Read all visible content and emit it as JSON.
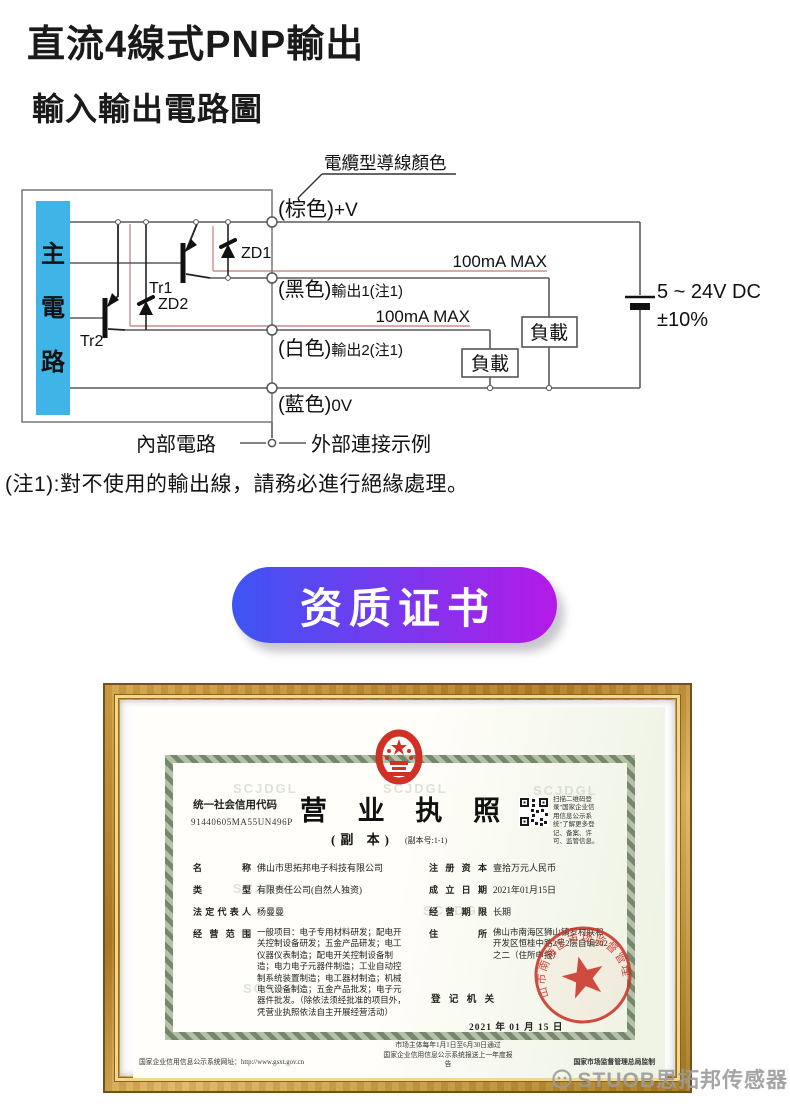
{
  "page": {
    "title": "直流4線式PNP輸出",
    "subtitle": "輸入輸出電路圖",
    "watermark": "STUOB思拓邦传感器"
  },
  "circuit": {
    "pointer_label": "電纜型導線顏色",
    "main_chars": [
      "主",
      "電",
      "路"
    ],
    "wires": [
      {
        "color": "(棕色)",
        "signal": "+V"
      },
      {
        "color": "(黑色)",
        "signal": "輸出1(注1)",
        "current": "100mA MAX"
      },
      {
        "color": "(白色)",
        "signal": "輸出2(注1)",
        "current": "100mA MAX"
      },
      {
        "color": "(藍色)",
        "signal": "0V"
      }
    ],
    "transistor1": "Tr1",
    "transistor2": "Tr2",
    "zener1": "ZD1",
    "zener2": "ZD2",
    "load_label": "負載",
    "supply_line1": "5 ~ 24V DC",
    "supply_line2": "±10%",
    "internal_label": "內部電路",
    "external_label": "外部連接示例",
    "note": "(注1):對不使用的輸出線，請務必進行絕緣處理。"
  },
  "cta": {
    "label": "资质证书",
    "gradient_from": "#3d55f3",
    "gradient_to": "#b41ae8"
  },
  "license": {
    "bg_watermark": "SCJDGL",
    "code_label": "统一社会信用代码",
    "code_value": "91440605MA55UN496P",
    "title": "营 业 执 照",
    "subtitle": "(副 本)",
    "copy_no": "(副本号:1-1)",
    "qr_caption": "扫描二维码登录\"国家企业信用信息公示系统\"了解更多登记、备案、许可、监管信息。",
    "fields_left": [
      {
        "label": "名称",
        "value": "佛山市思拓邦电子科技有限公司"
      },
      {
        "label": "类型",
        "value": "有限责任公司(自然人独资)"
      },
      {
        "label": "法定代表人",
        "value": "杨曼曼"
      },
      {
        "label": "经营范围",
        "value": "一般项目：电子专用材料研发；配电开关控制设备研发；五金产品研发；电工仪器仪表制造；配电开关控制设备制造；电力电子元器件制造；工业自动控制系统装置制造；电工器材制造；机械电气设备制造；五金产品批发；电子元器件批发。（除依法须经批准的项目外，凭营业执照依法自主开展经营活动）"
      }
    ],
    "fields_right": [
      {
        "label": "注册资本",
        "value": "壹拾万元人民币"
      },
      {
        "label": "成立日期",
        "value": "2021年01月15日"
      },
      {
        "label": "经营期限",
        "value": "长期"
      },
      {
        "label": "住所",
        "value": "佛山市南海区狮山镇罗村联和开发区恒桂中路2号2层自编202之二（住所申报）"
      }
    ],
    "registrar_label": "登 记 机 关",
    "stamp_text": "佛山市南海区市场监督管理局",
    "date": "2021 年 01 月 15 日",
    "footer_left": "国家企业信用信息公示系统网址：http://www.gsxt.gov.cn",
    "footer_mid1": "市场主体每年1月1日至6月30日通过",
    "footer_mid2": "国家企业信用信息公示系统报送上一年度报告",
    "footer_right": "国家市场监督管理总局监制",
    "stamp_color": "#c93428",
    "blue_bar_color": "#3fb4e6"
  }
}
